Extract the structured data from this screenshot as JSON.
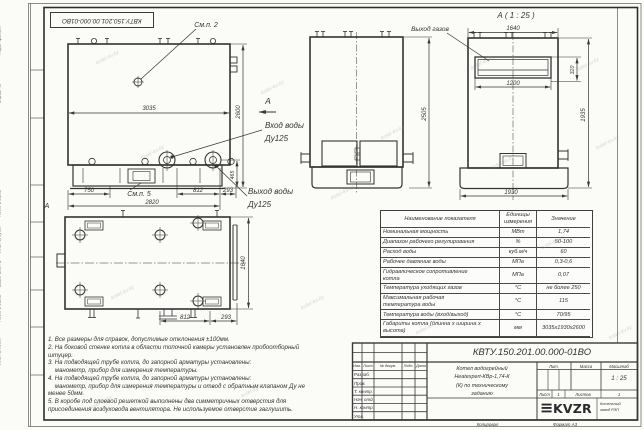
{
  "frame": {
    "labels": [
      "Перв. примен.",
      "Справ. №",
      "Подп. и дата",
      "Инв. № дубл.",
      "Взам. инв. №",
      "Подп. и дата",
      "Инв. № подл."
    ]
  },
  "doc": {
    "number": "КВТУ.150.201.00.000-01ВО",
    "number_top": "КВТУ.150.201.00.000-01ВО",
    "title_line1": "Котел водогрейный",
    "title_line2": "Heatexpert-КВр-1,74-К",
    "title_line3": "(К) по техническому",
    "title_line4": "заданию",
    "scale_value": "1 : 25",
    "sheet_value": "1",
    "sheets_value": "1",
    "copied_label": "Копировал",
    "format_note": "Формат А3",
    "logo_icon": "≡",
    "logo_text": "KVZR",
    "logo_caption_line1": "Котельный",
    "logo_caption_line2": "завод РЭП"
  },
  "stamp": {
    "cols": [
      "Изм.",
      "Лист",
      "№ докум.",
      "Подп.",
      "Дата"
    ],
    "rows": [
      "Разраб.",
      "Пров.",
      "Т. контр.",
      "Нач. отд.",
      "Н. контр.",
      "Утв."
    ],
    "lit_label": "Лит.",
    "mass_label": "Масса",
    "scale_label": "Масштаб",
    "sheet_label": "Лист",
    "sheets_label": "Листов"
  },
  "views": {
    "section_title": "А ( 1 : 25 )",
    "callout_top": "См.п. 2",
    "callout_base": "См.п. 5",
    "view_arrow": "А",
    "zone_letter": "А",
    "gas_outlet": "Выход газов",
    "water_in_line1": "Вход воды",
    "water_in_line2": "Ду125",
    "water_out_line1": "Выход воды",
    "water_out_line2": "Ду125"
  },
  "dims": {
    "overall_length": "3035",
    "overall_height": "2600",
    "front_height": "2505",
    "a_top_width": "1640",
    "gas_outlet_width": "1200",
    "gas_outlet_height": "320",
    "a_body_height": "1935",
    "a_base_width": "1930",
    "base_left": "750",
    "base_total": "2820",
    "base_mid": "812",
    "base_right": "293",
    "flange_height": "465",
    "plan_width": "1640",
    "plan_mid": "812",
    "plan_right": "293"
  },
  "notes": [
    "1. Все размеры для справок, допустимые отклонения ±100мм.",
    "2. На боковой стенке котла в области топочной камеры установлен пробоотборный\nштуцер.",
    "3. На подводящей трубе котла, до запорной арматуры установлены:\n    манометр, прибор для измерения температуры.",
    "4. На подводящей трубе котла, до запорной арматуры установлены:\n    манометр, прибор для измерения температуры и отвод с обратным клапаном Ду не\nменее 50мм.",
    "5. В коробе под слоевой решеткой выполнены два симметричных отверстия для\nприсоединения воздуховода вентилятора. Не используемое отверстие заглушить."
  ],
  "table": {
    "headers": [
      "Наименование показателя",
      "Единицы\nизмерения",
      "Значение"
    ],
    "rows": [
      [
        "Номинальная мощность",
        "МВт",
        "1,74"
      ],
      [
        "Диапазон рабочего регулирования",
        "%",
        "50-100"
      ],
      [
        "Расход воды",
        "куб.м/ч",
        "60"
      ],
      [
        "Рабочее давление воды",
        "МПа",
        "0,3-0,6"
      ],
      [
        "Гидравлическое сопротивление\nкотла",
        "МПа",
        "0,07"
      ],
      [
        "Температура уходящих газов",
        "°С",
        "не более 250"
      ],
      [
        "Максимальная рабочая\nтемпература воды",
        "°С",
        "115"
      ],
      [
        "Температура воды (вход/выход)",
        "°С",
        "70/95"
      ],
      [
        "Габариты котла (длинна х ширина х\nвысота)",
        "мм",
        "3035х1930х2600"
      ]
    ]
  },
  "watermark": {
    "text": "kotel-kv.kz"
  }
}
